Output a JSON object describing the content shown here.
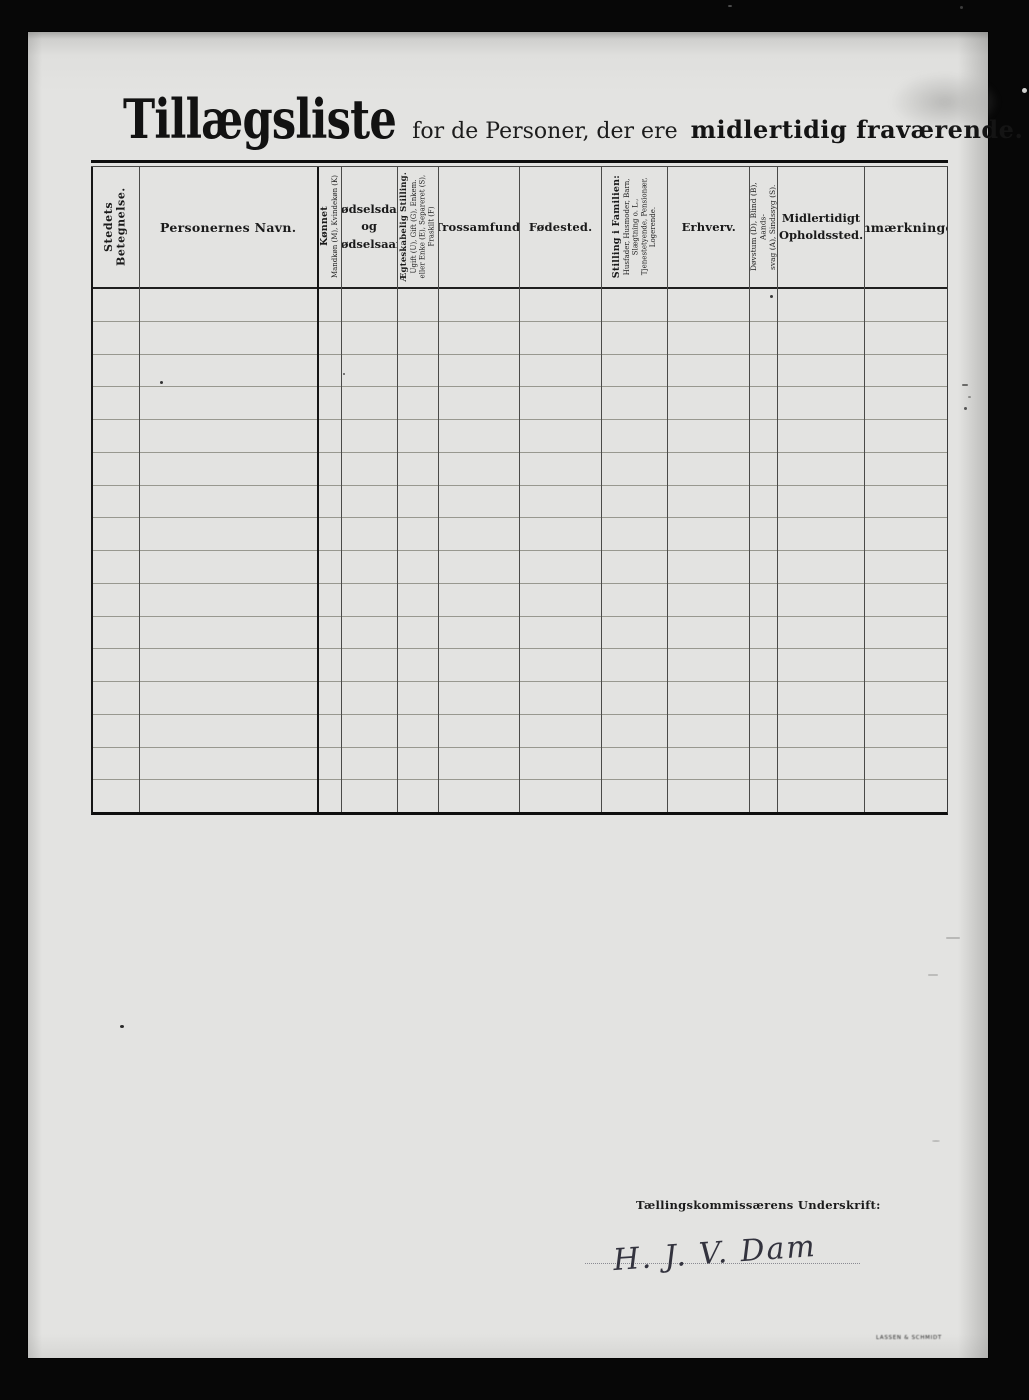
{
  "page": {
    "title_main": "Tillægsliste",
    "title_mid": "for de Personer, der ere",
    "title_bold": "midlertidig fraværende."
  },
  "colors": {
    "paper": "#e3e3e1",
    "background": "#070707",
    "ink": "#1a1a1a",
    "rule_line": "#98988f"
  },
  "table": {
    "row_count": 16,
    "columns": [
      {
        "id": "stedets-betegnelse",
        "label": "Stedets Betegnelse.",
        "orientation": "vertical"
      },
      {
        "id": "personernes-navn",
        "label": "Personernes Navn."
      },
      {
        "id": "koennet",
        "label": "Kønnet",
        "sub_lines": [
          "Mandkøn (M), Kvindekøn (K)"
        ],
        "orientation": "vertical"
      },
      {
        "id": "foedselsdag",
        "label": "Fødselsdag og Fødselsaar.",
        "lines": [
          "Fødselsdag",
          "og",
          "Fødselsaar."
        ]
      },
      {
        "id": "aegteskabelig-stilling",
        "label": "Ægteskabelig Stilling.",
        "sub_lines": [
          "Ugift (U), Gift (G), Enkem.",
          "eller Enke (E), Separeret (S),",
          "Fraskilt (F)"
        ],
        "orientation": "vertical"
      },
      {
        "id": "trossamfund",
        "label": "Trossamfund."
      },
      {
        "id": "foedested",
        "label": "Fødested."
      },
      {
        "id": "stilling-i-familien",
        "label": "Stilling i Familien:",
        "sub_lines": [
          "Husfader, Husmoder, Barn,",
          "Slægtning o. L.,",
          "Tjenestetyende, Pensionær,",
          "Logerende."
        ],
        "orientation": "vertical"
      },
      {
        "id": "erhverv",
        "label": "Erhverv."
      },
      {
        "id": "doevstum",
        "label": "",
        "sub_lines": [
          "Døvstum (D), Blind (B), Aands-",
          "svag (A), Sindssyg (S)."
        ],
        "orientation": "vertical"
      },
      {
        "id": "midlertidigt-opholdssted",
        "label": "Midlertidigt Opholdssted.",
        "lines": [
          "Midlertidigt",
          "Opholdssted."
        ]
      },
      {
        "id": "anmaerkninger",
        "label": "Anmærkninger"
      }
    ],
    "rows": []
  },
  "footer": {
    "signature_label": "Tællingskommissærens Underskrift:",
    "signature_value": "H. J. V. Dam",
    "printers_mark": "LASSEN & SCHMIDT"
  }
}
